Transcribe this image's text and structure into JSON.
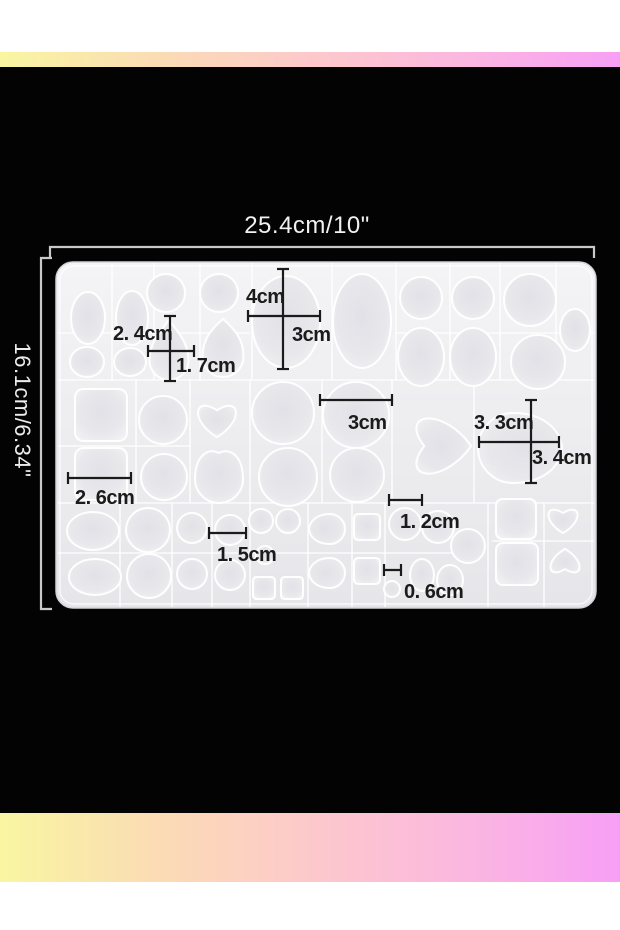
{
  "image": {
    "type": "e-commerce product photo",
    "subject": "white silicone gem / cabochon casting mold shown top-down with dimension callouts"
  },
  "palette": {
    "page_background": "#030303",
    "white_band": "#ffffff",
    "gradient_stops": [
      "#f9f6a1",
      "#fbdcb4",
      "#fcc9cb",
      "#fbb7e0",
      "#f79ff5"
    ],
    "mold_body": "#efeff2",
    "mold_outline": "#ffffff",
    "annotation_color": "#1b1b1b",
    "bracket_color": "#c9c9c9",
    "title_color": "#f1f1f1"
  },
  "overall_dimensions": {
    "width_label": "25.4cm/10\"",
    "height_label": "16.1cm/6.34\""
  },
  "annotations": {
    "labels": [
      {
        "text": "4cm",
        "x": 246,
        "y": 303
      },
      {
        "text": "3cm",
        "x": 292,
        "y": 341
      },
      {
        "text": "2. 4cm",
        "x": 113,
        "y": 340
      },
      {
        "text": "1. 7cm",
        "x": 176,
        "y": 372
      },
      {
        "text": "2. 6cm",
        "x": 75,
        "y": 504
      },
      {
        "text": "3cm",
        "x": 348,
        "y": 429
      },
      {
        "text": "3. 3cm",
        "x": 474,
        "y": 429
      },
      {
        "text": "3. 4cm",
        "x": 532,
        "y": 464
      },
      {
        "text": "1. 5cm",
        "x": 217,
        "y": 561
      },
      {
        "text": "1. 2cm",
        "x": 400,
        "y": 528
      },
      {
        "text": "0. 6cm",
        "x": 404,
        "y": 598
      }
    ],
    "lines": [
      [
        283,
        269,
        283,
        369
      ],
      [
        248,
        316,
        320,
        316
      ],
      [
        170,
        316,
        170,
        381
      ],
      [
        148,
        351,
        194,
        351
      ],
      [
        68,
        478,
        131,
        478
      ],
      [
        320,
        400,
        392,
        400
      ],
      [
        531,
        400,
        531,
        483
      ],
      [
        479,
        442,
        559,
        442
      ],
      [
        209,
        533,
        246,
        533
      ],
      [
        389,
        500,
        422,
        500
      ],
      [
        384,
        570,
        401,
        570
      ]
    ]
  },
  "mold": {
    "cavities": [
      [
        "ellipse",
        88,
        318,
        17,
        26
      ],
      [
        "ellipse",
        87,
        362,
        17,
        15
      ],
      [
        "ellipse",
        132,
        318,
        16,
        27
      ],
      [
        "ellipse",
        130,
        362,
        16,
        14
      ],
      [
        "circle",
        166,
        293,
        19
      ],
      [
        "drop",
        169,
        350,
        39,
        60,
        0
      ],
      [
        "circle",
        219,
        293,
        19
      ],
      [
        "drop",
        223,
        348,
        41,
        58,
        0
      ],
      [
        "ellipse",
        286,
        322,
        34,
        46
      ],
      [
        "ellipse",
        362,
        321,
        29,
        47
      ],
      [
        "circle",
        421,
        298,
        21
      ],
      [
        "ellipse",
        421,
        357,
        23,
        29
      ],
      [
        "circle",
        473,
        298,
        21
      ],
      [
        "ellipse",
        473,
        357,
        23,
        29
      ],
      [
        "circle",
        530,
        300,
        26
      ],
      [
        "circle",
        538,
        362,
        27
      ],
      [
        "ellipse",
        575,
        330,
        15,
        21
      ],
      [
        "square",
        101,
        415,
        52
      ],
      [
        "square",
        101,
        474,
        52
      ],
      [
        "circle",
        163,
        420,
        24
      ],
      [
        "circle",
        164,
        477,
        23
      ],
      [
        "heart",
        217,
        417,
        52,
        48,
        0
      ],
      [
        "drop",
        219,
        478,
        48,
        50,
        0
      ],
      [
        "circle",
        283,
        413,
        31
      ],
      [
        "circle",
        288,
        477,
        29
      ],
      [
        "circle",
        356,
        415,
        33
      ],
      [
        "circle",
        357,
        475,
        27
      ],
      [
        "heart",
        436,
        446,
        76,
        84,
        -90
      ],
      [
        "drop",
        520,
        448,
        70,
        84,
        90
      ],
      [
        "ellipse",
        93,
        531,
        26,
        19
      ],
      [
        "ellipse",
        95,
        577,
        26,
        18
      ],
      [
        "circle",
        148,
        530,
        22
      ],
      [
        "circle",
        149,
        576,
        22
      ],
      [
        "circle",
        192,
        528,
        15
      ],
      [
        "circle",
        192,
        574,
        15
      ],
      [
        "circle",
        230,
        530,
        15
      ],
      [
        "circle",
        230,
        575,
        15
      ],
      [
        "circle",
        261,
        521,
        12
      ],
      [
        "circle",
        288,
        521,
        12
      ],
      [
        "circle",
        265,
        555,
        9
      ],
      [
        "square",
        264,
        588,
        22
      ],
      [
        "square",
        292,
        588,
        22
      ],
      [
        "drop",
        327,
        529,
        30,
        36,
        -90
      ],
      [
        "drop",
        327,
        573,
        30,
        36,
        -90
      ],
      [
        "square",
        367,
        527,
        26
      ],
      [
        "square",
        367,
        571,
        26
      ],
      [
        "circle",
        405,
        524,
        16
      ],
      [
        "circle",
        438,
        527,
        16
      ],
      [
        "circle",
        468,
        546,
        17
      ],
      [
        "circle",
        392,
        589,
        8
      ],
      [
        "ellipse",
        422,
        575,
        12,
        16
      ],
      [
        "ellipse",
        450,
        580,
        13,
        15
      ],
      [
        "square",
        516,
        519,
        40
      ],
      [
        "square",
        517,
        564,
        42
      ],
      [
        "heart",
        563,
        518,
        40,
        36,
        0
      ],
      [
        "heart",
        565,
        564,
        40,
        36,
        180
      ]
    ]
  }
}
